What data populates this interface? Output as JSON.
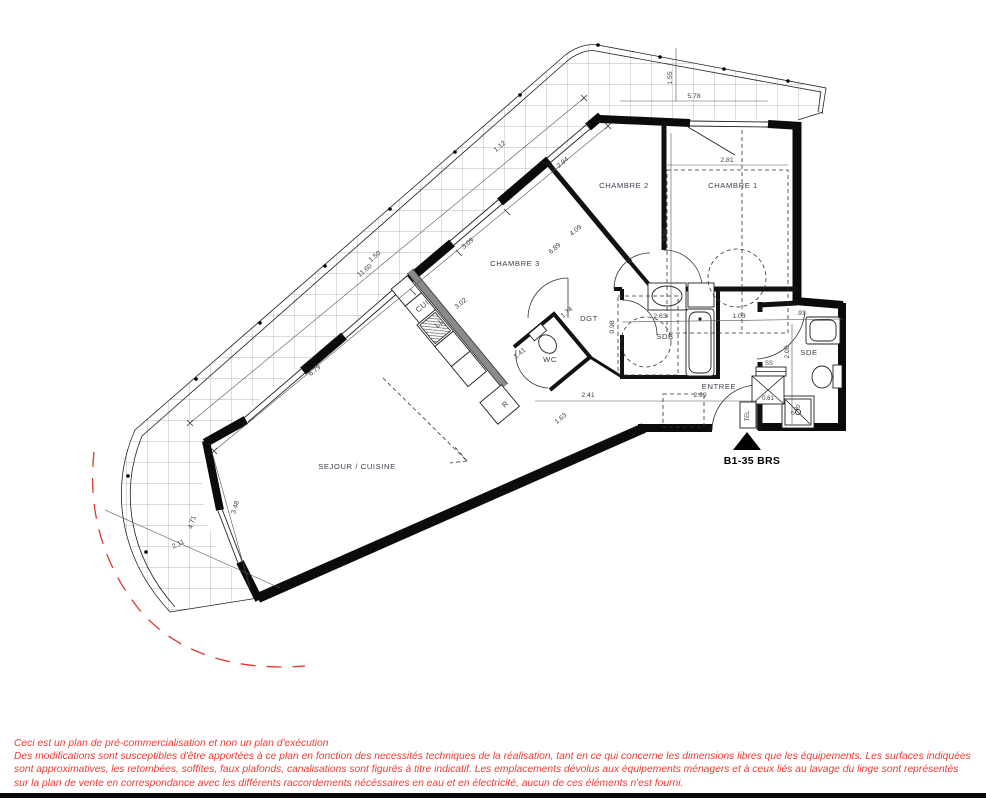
{
  "plan": {
    "unit_label": "B1-35 BRS",
    "rooms": {
      "chambre1": "CHAMBRE 1",
      "chambre2": "CHAMBRE 2",
      "chambre3": "CHAMBRE 3",
      "sejour": "SEJOUR / CUISINE",
      "entree": "ENTREE",
      "sdb": "SDB",
      "sde": "SDE",
      "wc": "WC",
      "dgt": "DGT",
      "cui": "CUI",
      "ll": "LL",
      "r": "R",
      "ss": "SS",
      "tel": "TEL"
    },
    "dims": {
      "balcony_top_len": "5.78",
      "balcony_top_depth": "1.55",
      "ch1_width": "2.81",
      "ch1_depth": "3.96",
      "ch2_window": "2.94",
      "ch2_depth": "4.09",
      "ch2_diag": "6.89",
      "ch2_win_small": "1.12",
      "ch3_window": "3.09",
      "ch3_width": "3.02",
      "balcony_len": "11.60",
      "balcony_depth": "1.50",
      "terrace_len": "6.79",
      "sej_window": "3.48",
      "sej_left": "4.71",
      "sej_left2": "2.11",
      "sdb_width": "2.63",
      "sdb_right": "1.03",
      "sdb_height": "0.98",
      "sde_top": ".93",
      "sde_depth": "2.00",
      "entree_width": "2.99",
      "entree_left": "2.41",
      "wc_diag": "1.63",
      "wc_width": "1.41",
      "dgt_diag": "1.74",
      "gaine": "0.61",
      "shower": "0.90"
    },
    "colors": {
      "wall": "#0b0b0b",
      "dimension_text": "#3a4250",
      "disclaimer_red": "#ef3b35",
      "grid": "#9aa0a6",
      "plumbing_wall": "#8a8a8a"
    }
  },
  "footer": {
    "line1": "Ceci est un plan de pré-commercialisation et non un plan d'exécution",
    "line2": "Des modifications sont susceptibles d'être apportées à ce plan en fonction des necessités techniques de la réalisation, tant en ce qui concerne les dimensions libres que les équipements. Les surfaces indiquées",
    "line3": "sont approximatives, les retombées, soffites, faux plafonds, canalisations sont figurés à titre indicatif. Les emplacements dévolus aux équipements ménagers et à ceux liés au lavage du linge sont représentés",
    "line4": "sur la plan de vente en correspondance avec les différents raccordements nécéssaires en eau et en électricité, aucun de ces éléments n'est fourni."
  }
}
